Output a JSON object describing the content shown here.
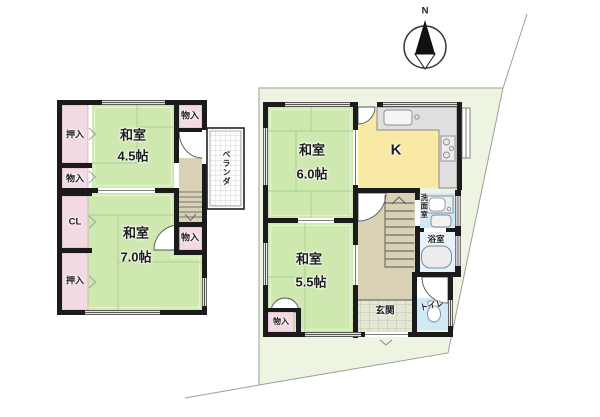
{
  "compass": {
    "north_label": "N"
  },
  "floor2": {
    "closet_top": "押入",
    "storage_left": "物入",
    "closet_cl_label": "CL",
    "closet_bottom": "押入",
    "room_45": {
      "name": "和室",
      "size": "4.5帖"
    },
    "storage_top_right": "物入",
    "veranda_label": "ベランダ",
    "storage_right": "物入",
    "room_70": {
      "name": "和室",
      "size": "7.0帖"
    }
  },
  "floor1": {
    "room_60": {
      "name": "和室",
      "size": "6.0帖"
    },
    "kitchen_label": "K",
    "washroom_label": "洗面室",
    "bathroom_label": "浴室",
    "room_55": {
      "name": "和室",
      "size": "5.5帖"
    },
    "toilet_label": "トイレ",
    "entrance_label": "玄関",
    "storage_label": "物入"
  },
  "colors": {
    "tatami_green": "#cfe8b0",
    "closet_pink": "#f3d9e3",
    "kitchen_yellow": "#f8e9a4",
    "water_blue": "#cfe9f7",
    "bath_blue": "#e7f3fa",
    "hall_beige": "#d8d1b6",
    "entrance_tile": "#e3e7d3",
    "site_green": "#edf4e2",
    "wall": "#1b1b1b"
  }
}
